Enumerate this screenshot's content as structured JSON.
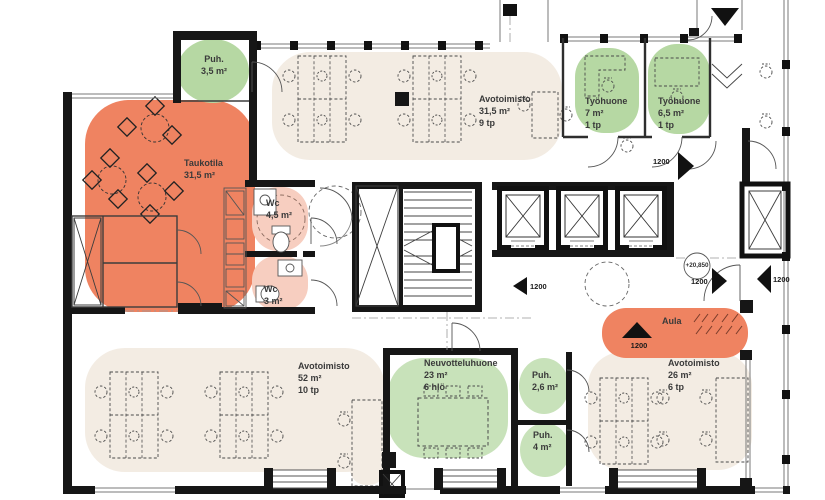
{
  "plan": {
    "rooms": [
      {
        "name": "Puh.",
        "area": "3,5 m²"
      },
      {
        "name": "Taukotila",
        "area": "31,5 m²"
      },
      {
        "name": "Avotoimisto",
        "area": "31,5 m²",
        "capacity": "9 tp"
      },
      {
        "name": "Työhuone",
        "area": "7 m²",
        "capacity": "1 tp"
      },
      {
        "name": "Työhuone",
        "area": "6,5 m²",
        "capacity": "1 tp"
      },
      {
        "name": "Wc",
        "area": "4,5 m²"
      },
      {
        "name": "Wc",
        "area": "3 m²"
      },
      {
        "name": "Aula"
      },
      {
        "name": "Avotoimisto",
        "area": "52 m²",
        "capacity": "10 tp"
      },
      {
        "name": "Neuvotteluhuone",
        "area": "23 m²",
        "capacity": "6 hlö"
      },
      {
        "name": "Puh.",
        "area": "2,6 m²"
      },
      {
        "name": "Puh.",
        "area": "4 m²"
      },
      {
        "name": "Avotoimisto",
        "area": "26 m²",
        "capacity": "6 tp"
      }
    ],
    "dims": {
      "elevator_hall": "1200",
      "workroom_corridor": "1200",
      "hall_right": "1200",
      "right_edge": "1200",
      "aula_entry": "1200"
    },
    "level_marker": "+20,850",
    "colors": {
      "breakout_orange": "#ef8361",
      "wc_pink": "#f7cec0",
      "room_green": "#b6d8a3",
      "office_beige": "#f3ece3",
      "wall": "#161616"
    }
  }
}
